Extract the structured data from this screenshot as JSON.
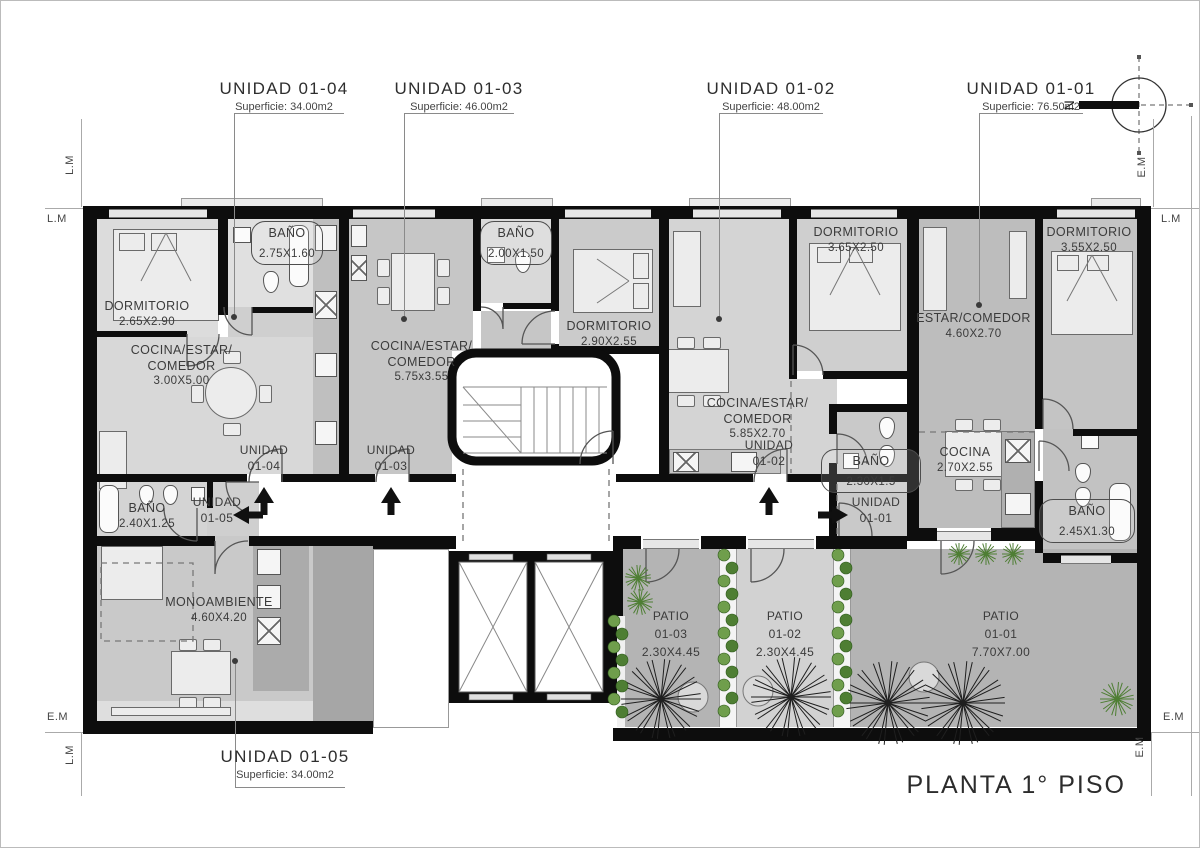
{
  "title_block": {
    "plan_title": "PLANTA 1° PISO"
  },
  "north": {
    "label": "N"
  },
  "boundary": {
    "lm": "L.M",
    "em": "E.M"
  },
  "unit_titles": {
    "u04": {
      "title": "UNIDAD 01-04",
      "area": "Superficie: 34.00m2"
    },
    "u03": {
      "title": "UNIDAD 01-03",
      "area": "Superficie: 46.00m2"
    },
    "u02": {
      "title": "UNIDAD 01-02",
      "area": "Superficie: 48.00m2"
    },
    "u01": {
      "title": "UNIDAD 01-01",
      "area": "Superficie: 76.50m2"
    },
    "u05": {
      "title": "UNIDAD 01-05",
      "area": "Superficie: 34.00m2"
    }
  },
  "rooms": {
    "u04_dorm": {
      "name": "DORMITORIO",
      "dims": "2.65X2.90"
    },
    "u04_living": {
      "line1": "COCINA/ESTAR/",
      "line2": "COMEDOR",
      "dims": "3.00X5.00"
    },
    "u04_bano": {
      "name": "BAÑO",
      "dims": "2.75X1.60"
    },
    "u03_living": {
      "line1": "COCINA/ESTAR/",
      "line2": "COMEDOR",
      "dims": "5.75x3.55"
    },
    "u03_bano": {
      "name": "BAÑO",
      "dims": "2.00X1.50"
    },
    "u03_dorm": {
      "name": "DORMITORIO",
      "dims": "2.90X2.55"
    },
    "u02_dorm": {
      "name": "DORMITORIO",
      "dims": "3.65X2.50"
    },
    "u02_living": {
      "line1": "COCINA/ESTAR/",
      "line2": "COMEDOR",
      "dims": "5.85X2.70"
    },
    "u02_bano": {
      "name": "BAÑO",
      "dims": "2.30X1.5"
    },
    "u01_estar": {
      "name": "ESTAR/COMEDOR",
      "dims": "4.60X2.70"
    },
    "u01_dorm": {
      "name": "DORMITORIO",
      "dims": "3.55X2.50"
    },
    "u01_cocina": {
      "name": "COCINA",
      "dims": "2.70X2.55"
    },
    "u01_bano": {
      "name": "BAÑO",
      "dims": "2.45X1.30"
    },
    "u05_bano": {
      "name": "BAÑO",
      "dims": "2.40X1.25"
    },
    "u05_mono": {
      "name": "MONOAMBIENTE",
      "dims": "4.60X4.20"
    }
  },
  "entrances": {
    "u04": {
      "line1": "UNIDAD",
      "line2": "01-04"
    },
    "u03": {
      "line1": "UNIDAD",
      "line2": "01-03"
    },
    "u02": {
      "line1": "UNIDAD",
      "line2": "01-02"
    },
    "u01": {
      "line1": "UNIDAD",
      "line2": "01-01"
    },
    "u05": {
      "line1": "UNIDAD",
      "line2": "01-05"
    }
  },
  "patios": {
    "p03": {
      "name": "PATIO",
      "id": "01-03",
      "dims": "2.30X4.45"
    },
    "p02": {
      "name": "PATIO",
      "id": "01-02",
      "dims": "2.30X4.45"
    },
    "p01": {
      "name": "PATIO",
      "id": "01-01",
      "dims": "7.70X7.00"
    }
  },
  "colors": {
    "wall": "#0d0d0d",
    "room_light": "#dcdcdc",
    "room_mid": "#c9c9c9",
    "room_dark": "#b5b5b5",
    "patio_dark": "#b4b4b4",
    "patio_light": "#d2d2d2",
    "plant_green": "#4e7e33",
    "plant_green_light": "#6f9e4c",
    "tree_line": "#1f1f1f",
    "text": "#3b3b3b"
  }
}
